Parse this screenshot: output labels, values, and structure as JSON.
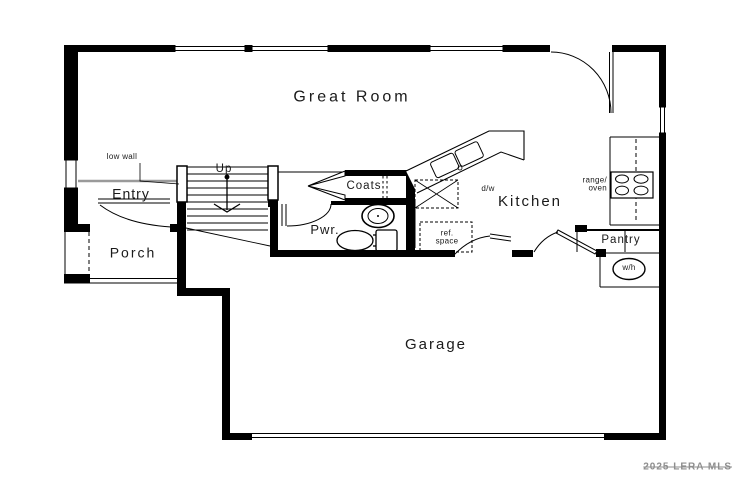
{
  "labels": {
    "great_room": "Great Room",
    "entry": "Entry",
    "porch": "Porch",
    "kitchen": "Kitchen",
    "garage": "Garage",
    "pwr": "Pwr.",
    "coats": "Coats",
    "pantry": "Pantry",
    "low_wall": "low wall",
    "up": "Up",
    "dw": "d/w",
    "range_oven": [
      "range/",
      "oven"
    ],
    "ref_space": [
      "ref.",
      "space"
    ],
    "wh": "w/h"
  },
  "watermark": "2025 LERA MLS",
  "colors": {
    "wall": "#000000",
    "label": "#1a1a1a",
    "low_wall_line": "#9a9a9a",
    "watermark": "#8e8e8e"
  }
}
